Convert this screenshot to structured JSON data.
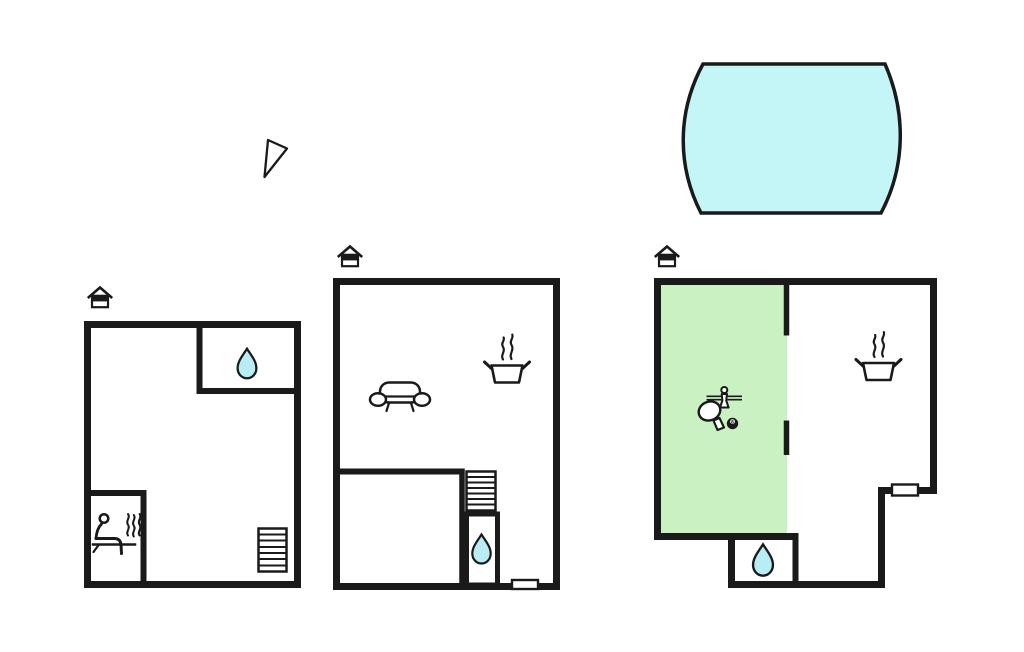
{
  "sheet": {
    "name": "holiday-home-floor-plan-sheet"
  },
  "colors": {
    "wall": "#1a1a1a",
    "pool_fill": "#c4f6f7",
    "drop_fill": "#b9edf6",
    "green_room_fill": "#c9f1c1",
    "paper": "#ffffff"
  },
  "pool": {
    "icon": "swimming-pool"
  },
  "compass": {
    "icon": "north-arrow"
  },
  "plans": [
    {
      "id": "floor-plan-1",
      "icons": [
        "home-entrance-marker",
        "water-drop-bathroom",
        "sauna-person-with-steam",
        "staircase"
      ]
    },
    {
      "id": "floor-plan-2",
      "icons": [
        "home-entrance-marker",
        "sofa",
        "cooking-pot-kitchen",
        "staircase",
        "water-drop-bathroom",
        "door-marker"
      ]
    },
    {
      "id": "floor-plan-3",
      "icons": [
        "home-entrance-marker",
        "green-recreation-room",
        "foosball-player",
        "table-tennis-paddle",
        "billiard-8-ball",
        "cooking-pot-kitchen",
        "water-drop-bathroom",
        "door-marker"
      ]
    }
  ],
  "labels": {
    "eight_ball": "8"
  }
}
